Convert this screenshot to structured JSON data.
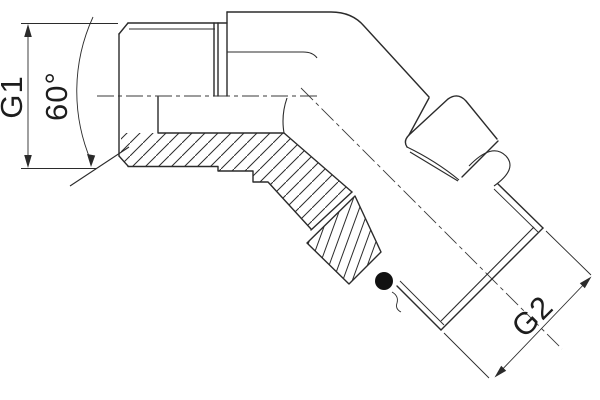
{
  "drawing": {
    "type": "technical-drawing",
    "subject": "60-degree adjustable elbow pipe fitting, half-section view",
    "labels": {
      "g1": "G1",
      "angle": "60°",
      "g2": "G2"
    }
  },
  "colors": {
    "line": "#2b2b2b",
    "background": "#ffffff",
    "o_ring": "#111111"
  }
}
